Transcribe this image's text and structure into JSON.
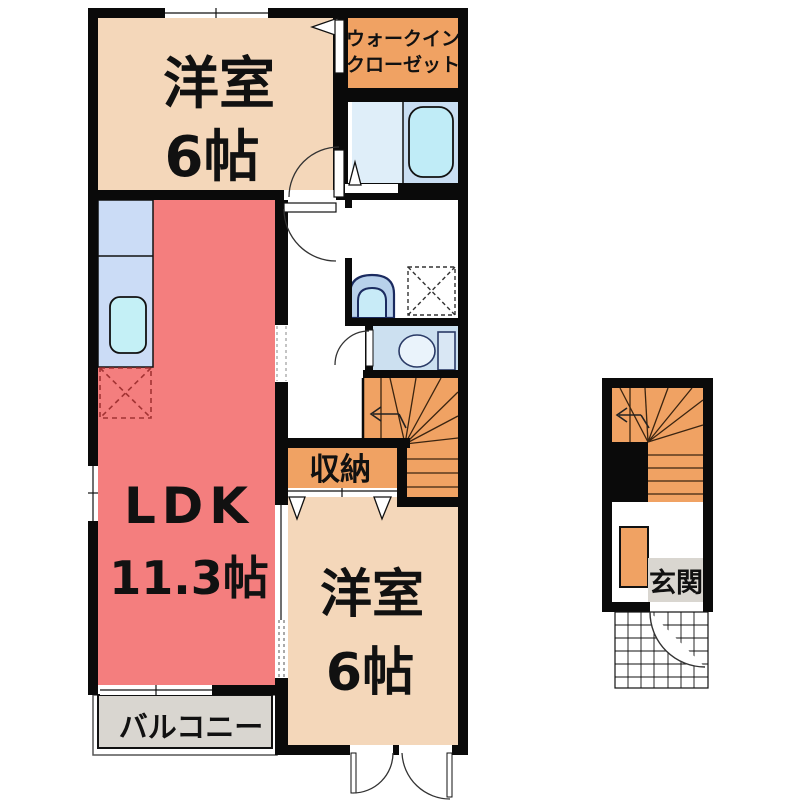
{
  "floorplan": {
    "rooms": {
      "bedroom1": {
        "label": "洋室",
        "size": "6帖"
      },
      "walk_in_closet": {
        "line1": "ウォークイン",
        "line2": "クローゼット"
      },
      "ldk": {
        "label": "LDK",
        "size": "11.3帖"
      },
      "storage": {
        "label": "収納"
      },
      "bedroom2": {
        "label": "洋室",
        "size": "6帖"
      },
      "balcony": {
        "label": "バルコニー"
      },
      "entrance": {
        "label": "玄関"
      }
    },
    "colors": {
      "wall": "#0a0a0a",
      "bedroom_tan": "#f4d7ba",
      "ldk_red": "#f47e7e",
      "closet_orange": "#f0a263",
      "bath_room_blue": "#dfeef9",
      "bath_panel_blue": "#c9def2",
      "tub_cyan": "#c0ecf7",
      "counter_blue": "#cbdcf6",
      "sink_cyan": "#c4f0f6",
      "toilet_room_blue": "#cce0f0",
      "basin_navy": "#1b2b60",
      "balcony_gray": "#d9d6d0"
    }
  }
}
